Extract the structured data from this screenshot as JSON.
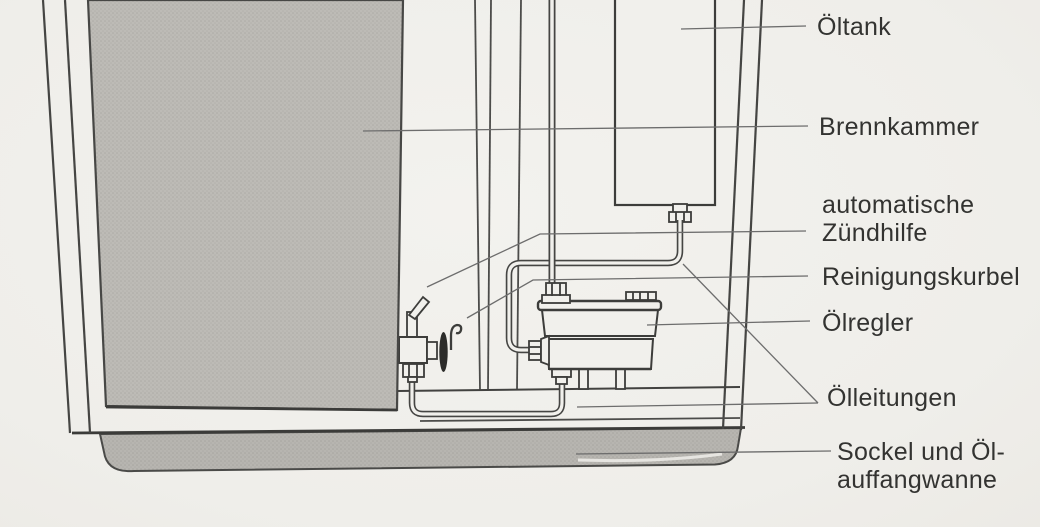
{
  "diagram": {
    "labels": [
      {
        "id": "oeltank",
        "text": "Öltank"
      },
      {
        "id": "brennkammer",
        "text": "Brennkammer"
      },
      {
        "id": "zuendhilfe",
        "lines": [
          "automatische",
          "Zündhilfe"
        ]
      },
      {
        "id": "reinigungskurbel",
        "text": "Reinigungskurbel"
      },
      {
        "id": "oelregler",
        "text": "Ölregler"
      },
      {
        "id": "oelleitungen",
        "text": "Ölleitungen"
      },
      {
        "id": "sockel",
        "lines": [
          "Sockel und Öl-",
          "auffangwanne"
        ]
      }
    ],
    "colors": {
      "paper": "#f1f0ec",
      "line": "#3f3f3f",
      "leader": "#6d6d6d",
      "panel_grey": "#bcbab5",
      "base_grey": "#b6b4af",
      "text": "#333331"
    }
  }
}
